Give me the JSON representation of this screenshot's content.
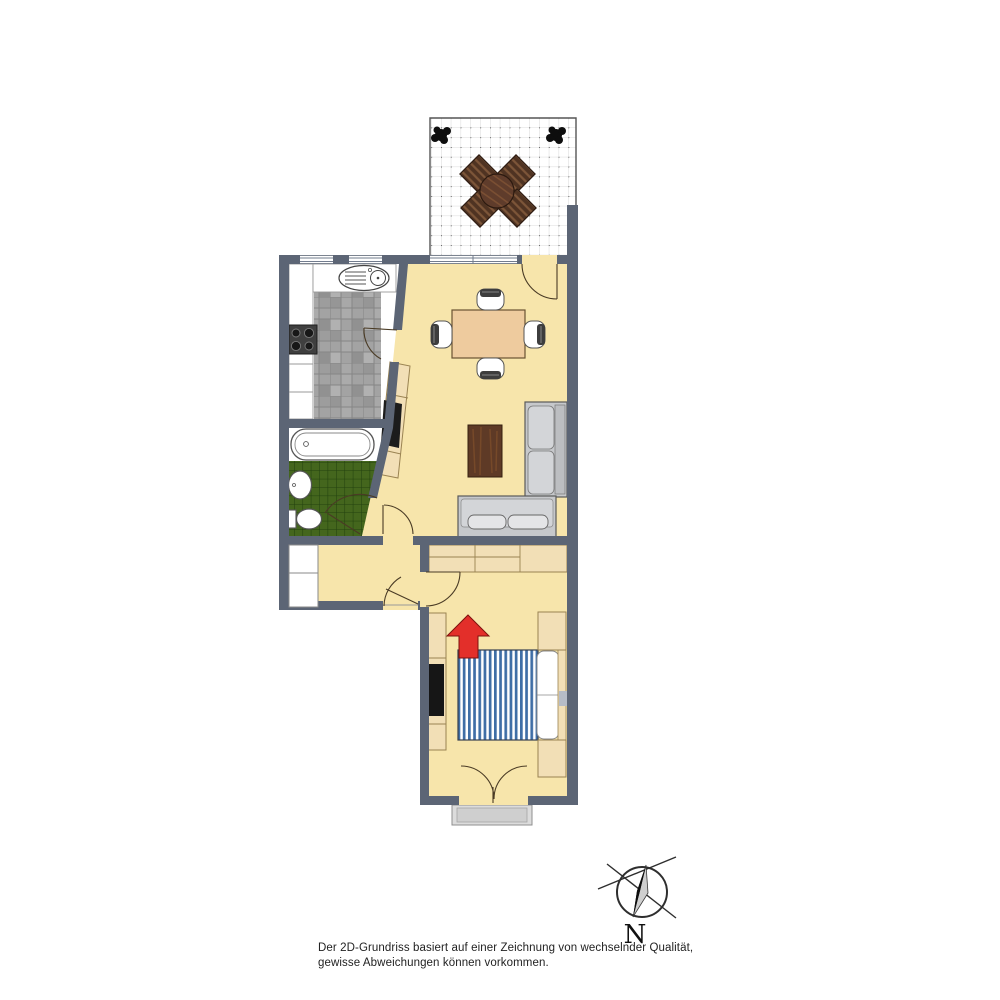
{
  "disclaimer": {
    "line1": "Der 2D-Grundriss basiert auf einer Zeichnung von wechselnder Qualität,",
    "line2": "gewisse Abweichungen können vorkommen."
  },
  "compass": {
    "label": "N"
  },
  "colors": {
    "wall": "#5c6575",
    "floor": "#f7e5ab",
    "kitchen_tiles": "#a3a3a3",
    "bathroom_tiles": "#44661d",
    "furniture_beige": "#f2dfb6",
    "sofa": "#c6c8cb",
    "bed_stripe_blue": "#3f6ea6",
    "coffee_table_wood": "#5e3a26",
    "dining_table": "#eecb9e",
    "terrace_table_wood": "#5f3c2b",
    "entrance_arrow": "#e32f2a",
    "outdoor_step": "#dcdcdc"
  },
  "rooms": [
    {
      "id": "terrace",
      "features": [
        "tiled-floor",
        "plant",
        "plant",
        "round-table",
        "four-chairs"
      ]
    },
    {
      "id": "kitchen",
      "features": [
        "counter",
        "stove",
        "sink",
        "tiled-floor",
        "windows"
      ]
    },
    {
      "id": "bathroom",
      "features": [
        "bathtub",
        "washbasin",
        "toilet",
        "tiled-floor"
      ]
    },
    {
      "id": "living-dining-room",
      "features": [
        "dining-table",
        "four-chairs",
        "coffee-table",
        "corner-sofa",
        "tv-sideboard",
        "terrace-door",
        "window"
      ]
    },
    {
      "id": "hallway",
      "features": [
        "built-in-closet",
        "entry-door"
      ]
    },
    {
      "id": "bedroom",
      "features": [
        "double-bed",
        "wardrobe",
        "nightstand",
        "nightstand",
        "tv-dresser",
        "entrance-arrow",
        "french-door",
        "outdoor-step"
      ]
    }
  ]
}
